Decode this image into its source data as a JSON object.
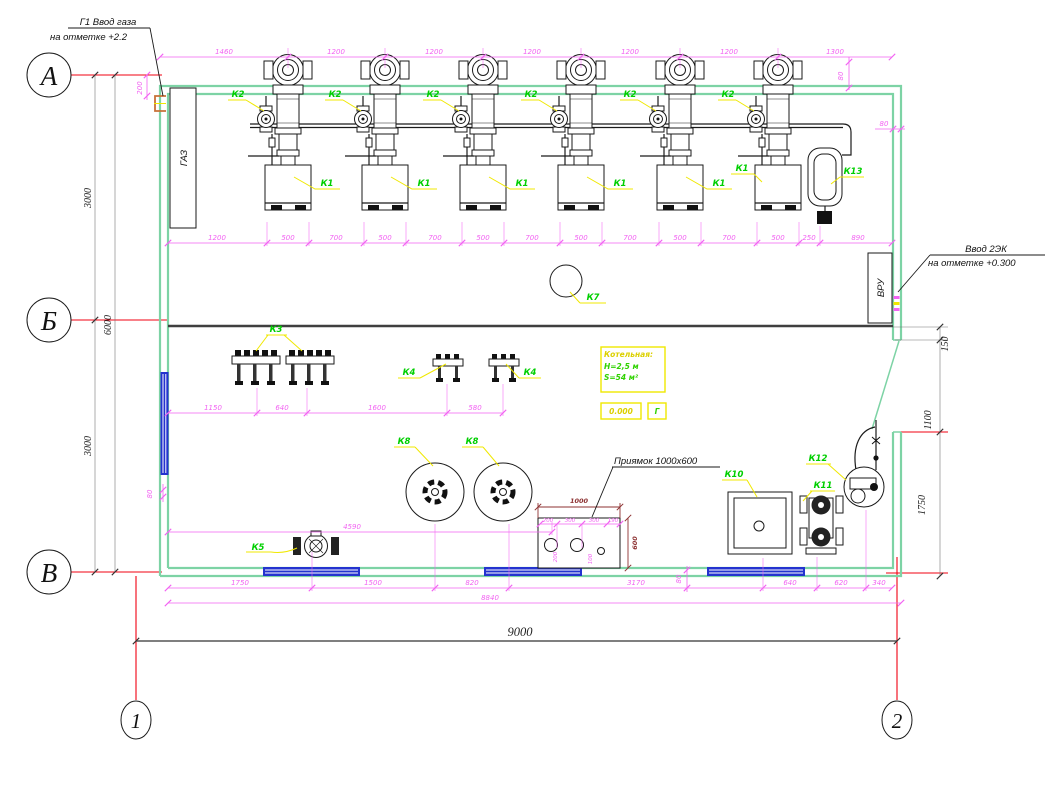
{
  "axes": {
    "a": "А",
    "b": "Б",
    "v": "В",
    "n1": "1",
    "n2": "2"
  },
  "annotations": {
    "gas_line1": "Г1 Ввод газа",
    "gas_line2": "на отметке +2.2",
    "elec_line1": "Ввод 2ЭК",
    "elec_line2": "на отметке +0.300",
    "pit_label": "Приямок 1000x600",
    "gas_riser": "ГАЗ",
    "vru": "ВРУ"
  },
  "note": {
    "title": "Котельная:",
    "height": "H=2,5 м",
    "area": "S=54 м²",
    "level": "0.000",
    "letter": "Г"
  },
  "equipment": {
    "k1": "К1",
    "k2": "К2",
    "k3": "К3",
    "k4": "К4",
    "k5": "К5",
    "k7": "К7",
    "k8": "К8",
    "k10": "К10",
    "k11": "К11",
    "k12": "К12",
    "k13": "К13"
  },
  "dims": {
    "top": [
      "1460",
      "1200",
      "1200",
      "1200",
      "1200",
      "1200",
      "1300"
    ],
    "top_offset": "80",
    "wall_offset": "80",
    "gas_offset": "200",
    "left": [
      "3000",
      "6000",
      "3000"
    ],
    "boiler_row": [
      "1200",
      "500",
      "700",
      "500",
      "700",
      "500",
      "700",
      "500",
      "700",
      "500",
      "700",
      "500",
      "250",
      "890"
    ],
    "mid_row": [
      "1150",
      "640",
      "1600",
      "580"
    ],
    "right": [
      "150",
      "1100",
      "1750"
    ],
    "k5_row": "4590",
    "left_offset": "80",
    "bottom_offset": "80",
    "pit": {
      "w": "1000",
      "h": "600",
      "inner_h": [
        "200",
        "300",
        "300",
        "190"
      ],
      "inner_v": [
        "200",
        "100"
      ]
    },
    "bottom": [
      "1750",
      "1500",
      "820",
      "3170",
      "640",
      "620",
      "340"
    ],
    "interior": "8840",
    "overall": "9000"
  },
  "colors": {
    "wall": "#7dd3a5",
    "dimension": "#f263f2",
    "equipment_label": "#00cf00",
    "axis": "#f00012",
    "window": "#2433cf",
    "note_box": "#f0e800",
    "pit_dim": "#8d3232"
  }
}
